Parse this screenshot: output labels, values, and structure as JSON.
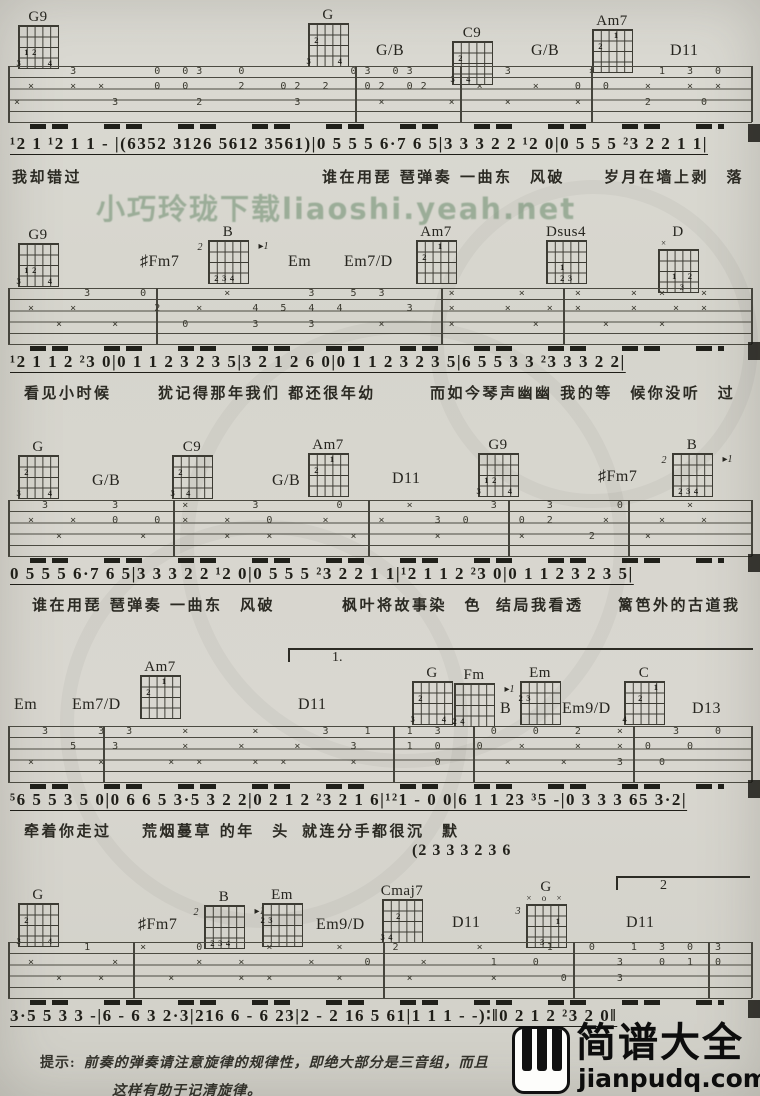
{
  "page": {
    "watermark_text": "小巧玲珑下载liaoshi.yeah.net",
    "tip_label": "提示:",
    "tip_line1": "前奏的弹奏请注意旋律的规律性，即绝大部分是三音组，而且",
    "tip_line2": "这样有助于记清旋律。",
    "logo_cn": "简谱大全",
    "logo_domain": "jianpudq.com",
    "logo_icon": "piano-keys"
  },
  "systems": [
    {
      "chords": [
        {
          "t": "dia",
          "label": "G9",
          "x": 16,
          "y": 10,
          "inner": [
            [
              2,
              1,
              "1"
            ],
            [
              2,
              2,
              "2"
            ],
            [
              3,
              0,
              "3"
            ],
            [
              3,
              4,
              "4"
            ]
          ]
        },
        {
          "t": "dia",
          "label": "G",
          "x": 306,
          "y": 8,
          "inner": [
            [
              1,
              1,
              "2"
            ],
            [
              3,
              0,
              "3"
            ],
            [
              3,
              4,
              "4"
            ]
          ]
        },
        {
          "t": "lbl",
          "label": "G/B",
          "x": 376,
          "y": 42
        },
        {
          "t": "dia",
          "label": "C9",
          "x": 450,
          "y": 26,
          "inner": [
            [
              1,
              1,
              "2"
            ],
            [
              3,
              0,
              "3"
            ],
            [
              3,
              2,
              "4"
            ]
          ]
        },
        {
          "t": "lbl",
          "label": "G/B",
          "x": 531,
          "y": 42
        },
        {
          "t": "dia",
          "label": "Am7",
          "x": 590,
          "y": 14,
          "inner": [
            [
              0,
              3,
              "1"
            ],
            [
              1,
              1,
              "2"
            ]
          ]
        },
        {
          "t": "lbl",
          "label": "D11",
          "x": 670,
          "y": 42
        }
      ],
      "staff": {
        "top": 66,
        "bars": [
          0,
          347,
          452,
          583,
          743
        ],
        "lanes": [
          {
            "y": 1,
            "t": "    3     0 03  0       03 03      3     ×    1 3 0"
          },
          {
            "y": 16,
            "t": " ×  × ×   0 0   2  02 2  02 02   ×   ×  0 0  ×  × ×"
          },
          {
            "y": 32,
            "t": "×      3     2      3     ×    ×   ×    ×    2   0 "
          }
        ]
      },
      "beams_top": 124,
      "melody": {
        "top": 134,
        "text": "¹2 1 ¹2 1 1 - |(6352 3126 5612 3561)|0 5 5 5 6·7 6 5|3 3 3 2 2 ¹2 0|0 5 5 5 ²3 2 2 1 1|"
      },
      "lyrics": {
        "top": 166,
        "segments": [
          {
            "x": 12,
            "text": "我却错过"
          },
          {
            "x": 322,
            "text": "谁在用琵 琶弹奏 一曲东　风破"
          },
          {
            "x": 604,
            "text": "岁月在墙上剥　落"
          }
        ]
      }
    },
    {
      "chords": [
        {
          "t": "dia",
          "label": "G9",
          "x": 16,
          "y": 228,
          "inner": [
            [
              2,
              1,
              "1"
            ],
            [
              2,
              2,
              "2"
            ],
            [
              3,
              0,
              "3"
            ],
            [
              3,
              4,
              "4"
            ]
          ]
        },
        {
          "t": "lbl",
          "label": "♯Fm7",
          "x": 140,
          "y": 253
        },
        {
          "t": "dia",
          "label": "B",
          "x": 206,
          "y": 225,
          "left": "2",
          "right": "▸1",
          "inner": [
            [
              3,
              1,
              "2"
            ],
            [
              3,
              2,
              "3"
            ],
            [
              3,
              3,
              "4"
            ]
          ]
        },
        {
          "t": "lbl",
          "label": "Em",
          "x": 288,
          "y": 253
        },
        {
          "t": "lbl",
          "label": "Em7/D",
          "x": 344,
          "y": 253
        },
        {
          "t": "dia",
          "label": "Am7",
          "x": 414,
          "y": 225,
          "inner": [
            [
              0,
              3,
              "1"
            ],
            [
              1,
              1,
              "2"
            ]
          ]
        },
        {
          "t": "dia",
          "label": "Dsus4",
          "x": 544,
          "y": 225,
          "inner": [
            [
              2,
              2,
              "1"
            ],
            [
              3,
              2,
              "2"
            ],
            [
              3,
              3,
              "3"
            ]
          ]
        },
        {
          "t": "dia",
          "label": "D",
          "x": 656,
          "y": 225,
          "top": "×    ",
          "inner": [
            [
              2,
              2,
              "1"
            ],
            [
              2,
              4,
              "2"
            ],
            [
              3,
              3,
              "3"
            ]
          ]
        }
      ],
      "staff": {
        "top": 288,
        "bars": [
          0,
          148,
          433,
          555,
          743
        ],
        "lanes": [
          {
            "y": 1,
            "t": "     3   0     ×     3  5 3    ×    ×   ×   × ×  × "
          },
          {
            "y": 16,
            "t": " ×  ×     2  ×   4 5 4 4    3  ×   ×  × ×   ×  × × "
          },
          {
            "y": 32,
            "t": "   ×   ×    0    3   3    ×    ×     ×    ×   ×    "
          }
        ]
      },
      "beams_top": 346,
      "melody": {
        "top": 352,
        "text": "¹2 1 1 2 ²3 0|0 1 1 2 3 2 3 5|3 2 1 2 6 0|0 1 1 2 3 2 3 5|6 5 5 3 3 ²3 3 3 2 2|"
      },
      "lyrics": {
        "top": 382,
        "segments": [
          {
            "x": 24,
            "text": "看见小时候"
          },
          {
            "x": 158,
            "text": "犹记得那年我们 都还很年幼"
          },
          {
            "x": 430,
            "text": "而如今琴声幽幽 我的等　候你没听　过"
          }
        ]
      }
    },
    {
      "chords": [
        {
          "t": "dia",
          "label": "G",
          "x": 16,
          "y": 440,
          "inner": [
            [
              1,
              1,
              "2"
            ],
            [
              3,
              0,
              "3"
            ],
            [
              3,
              4,
              "4"
            ]
          ]
        },
        {
          "t": "lbl",
          "label": "G/B",
          "x": 92,
          "y": 472
        },
        {
          "t": "dia",
          "label": "C9",
          "x": 170,
          "y": 440,
          "inner": [
            [
              1,
              1,
              "2"
            ],
            [
              3,
              0,
              "3"
            ],
            [
              3,
              2,
              "4"
            ]
          ]
        },
        {
          "t": "lbl",
          "label": "G/B",
          "x": 272,
          "y": 472
        },
        {
          "t": "dia",
          "label": "Am7",
          "x": 306,
          "y": 438,
          "inner": [
            [
              0,
              3,
              "1"
            ],
            [
              1,
              1,
              "2"
            ]
          ]
        },
        {
          "t": "lbl",
          "label": "D11",
          "x": 392,
          "y": 470
        },
        {
          "t": "dia",
          "label": "G9",
          "x": 476,
          "y": 438,
          "inner": [
            [
              2,
              1,
              "1"
            ],
            [
              2,
              2,
              "2"
            ],
            [
              3,
              0,
              "3"
            ],
            [
              3,
              4,
              "4"
            ]
          ]
        },
        {
          "t": "lbl",
          "label": "♯Fm7",
          "x": 598,
          "y": 468
        },
        {
          "t": "dia",
          "label": "B",
          "x": 670,
          "y": 438,
          "left": "2",
          "right": "▸1",
          "inner": [
            [
              3,
              1,
              "2"
            ],
            [
              3,
              2,
              "3"
            ],
            [
              3,
              3,
              "4"
            ]
          ]
        }
      ],
      "staff": {
        "top": 500,
        "bars": [
          0,
          165,
          360,
          500,
          620,
          743
        ],
        "lanes": [
          {
            "y": 1,
            "t": "  3    3    ×    3     0    ×     3   3    0    ×  "
          },
          {
            "y": 16,
            "t": " ×  ×  0  0 ×  ×  0   ×   ×   3 0   0 2   ×   ×  × "
          },
          {
            "y": 32,
            "t": "   ×     ×     ×  ×     ×     ×     ×    2   ×     "
          }
        ]
      },
      "beams_top": 558,
      "melody": {
        "top": 564,
        "text": "0 5 5 5 6·7 6 5|3 3 3 2 2 ¹2 0|0 5 5 5 ²3 2 2 1 1|¹2 1 1 2 ²3 0|0 1 1 2 3 2 3 5|"
      },
      "lyrics": {
        "top": 594,
        "segments": [
          {
            "x": 32,
            "text": "谁在用琵 琶弹奏 一曲东　风破"
          },
          {
            "x": 342,
            "text": "枫叶将故事染　色"
          },
          {
            "x": 496,
            "text": "结局我看透"
          },
          {
            "x": 618,
            "text": "篱笆外的古道我"
          }
        ]
      }
    },
    {
      "volta": {
        "label": "1.",
        "x": 288,
        "y": 648,
        "w": 465
      },
      "chords": [
        {
          "t": "lbl",
          "label": "Em",
          "x": 14,
          "y": 696
        },
        {
          "t": "lbl",
          "label": "Em7/D",
          "x": 72,
          "y": 696
        },
        {
          "t": "dia",
          "label": "Am7",
          "x": 138,
          "y": 660,
          "inner": [
            [
              0,
              3,
              "1"
            ],
            [
              1,
              1,
              "2"
            ]
          ]
        },
        {
          "t": "lbl",
          "label": "D11",
          "x": 298,
          "y": 696
        },
        {
          "t": "dia",
          "label": "G",
          "x": 410,
          "y": 666,
          "inner": [
            [
              1,
              1,
              "2"
            ],
            [
              3,
              0,
              "3"
            ],
            [
              3,
              4,
              "4"
            ]
          ]
        },
        {
          "t": "dia",
          "label": "Fm",
          "x": 452,
          "y": 668,
          "right": "▸1",
          "inner": [
            [
              3,
              0,
              "2"
            ],
            [
              3,
              1,
              "4"
            ]
          ]
        },
        {
          "t": "lbl",
          "label": "B",
          "x": 500,
          "y": 700
        },
        {
          "t": "dia",
          "label": "Em",
          "x": 518,
          "y": 666,
          "inner": [
            [
              1,
              0,
              "2"
            ],
            [
              1,
              1,
              "3"
            ]
          ]
        },
        {
          "t": "lbl",
          "label": "Em9/D",
          "x": 562,
          "y": 700
        },
        {
          "t": "dia",
          "label": "C",
          "x": 622,
          "y": 666,
          "inner": [
            [
              0,
              4,
              "1"
            ],
            [
              1,
              2,
              "2"
            ],
            [
              3,
              0,
              "4"
            ]
          ]
        },
        {
          "t": "lbl",
          "label": "D13",
          "x": 692,
          "y": 700
        }
      ],
      "staff": {
        "top": 726,
        "bars": [
          0,
          95,
          385,
          465,
          625,
          743
        ],
        "lanes": [
          {
            "y": 1,
            "t": "  3   3 3   ×    ×    3  1  1 3   0  0  2  ×   3  0"
          },
          {
            "y": 16,
            "t": "    5  3    ×   ×   ×   3   1 0  0  ×   ×  × 0  0  "
          },
          {
            "y": 32,
            "t": " ×    ×    × ×   × ×    ×     0    ×   ×   3  0    "
          }
        ]
      },
      "beams_top": 784,
      "melody": {
        "top": 790,
        "text": "⁵6 5 5 3 5 0|0 6 6 5 3·5 3 2 2|0 2 1 2 ²3 2 1 6|¹²1 - 0 0|6 1 1 23 ³5 -|0 3 3 3 65 3·2|"
      },
      "lyrics": {
        "top": 820,
        "segments": [
          {
            "x": 24,
            "text": "牵着你走过"
          },
          {
            "x": 142,
            "text": "荒烟蔓草 的年　头"
          },
          {
            "x": 302,
            "text": "就连分手都很沉　默"
          }
        ]
      },
      "extra": {
        "x": 412,
        "y": 842,
        "text": "(2 3 3 3 2 3 6"
      }
    },
    {
      "volta": {
        "label": "2",
        "x": 616,
        "y": 876,
        "w": 134
      },
      "chords": [
        {
          "t": "dia",
          "label": "G",
          "x": 16,
          "y": 888,
          "inner": [
            [
              1,
              1,
              "2"
            ],
            [
              3,
              0,
              "3"
            ],
            [
              3,
              4,
              "4"
            ]
          ]
        },
        {
          "t": "lbl",
          "label": "♯Fm7",
          "x": 138,
          "y": 916
        },
        {
          "t": "dia",
          "label": "B",
          "x": 202,
          "y": 890,
          "left": "2",
          "right": "▸1",
          "inner": [
            [
              3,
              1,
              "2"
            ],
            [
              3,
              2,
              "3"
            ],
            [
              3,
              3,
              "4"
            ]
          ]
        },
        {
          "t": "dia",
          "label": "Em",
          "x": 260,
          "y": 888,
          "inner": [
            [
              1,
              0,
              "2"
            ],
            [
              1,
              1,
              "3"
            ]
          ]
        },
        {
          "t": "lbl",
          "label": "Em9/D",
          "x": 316,
          "y": 916
        },
        {
          "t": "dia",
          "label": "Cmaj7",
          "x": 380,
          "y": 884,
          "inner": [
            [
              1,
              2,
              "2"
            ],
            [
              3,
              0,
              "3"
            ],
            [
              3,
              1,
              "4"
            ]
          ]
        },
        {
          "t": "lbl",
          "label": "D11",
          "x": 452,
          "y": 914
        },
        {
          "t": "dia",
          "label": "G",
          "x": 524,
          "y": 880,
          "top": "× o ×",
          "left": "3",
          "inner": [
            [
              1,
              4,
              "1"
            ],
            [
              3,
              2,
              "3"
            ]
          ]
        },
        {
          "t": "lbl",
          "label": "D11",
          "x": 626,
          "y": 914
        }
      ],
      "staff": {
        "top": 942,
        "bars": [
          0,
          125,
          375,
          565,
          700,
          743
        ],
        "lanes": [
          {
            "y": 1,
            "t": "     1   ×   0    ×    ×   2     ×    1  0  1 3 0 3"
          },
          {
            "y": 16,
            "t": " ×     ×     ×  ×    ×   0   ×    1  0     3  0 1 0"
          },
          {
            "y": 32,
            "t": "   ×  ×    ×    × ×    ×    ×     ×    0   3       "
          }
        ]
      },
      "beams_top": 1000,
      "melody": {
        "top": 1006,
        "text": "3·5 5 3 3 -|6 - 6 3 2·3|216 6 - 6 23|2 - 2 16 5 61|1 1 1 - -)∶‖0 2 1 2 ²3 2 0‖"
      }
    }
  ],
  "edge_marks": [
    124,
    342,
    554,
    780,
    1000
  ]
}
